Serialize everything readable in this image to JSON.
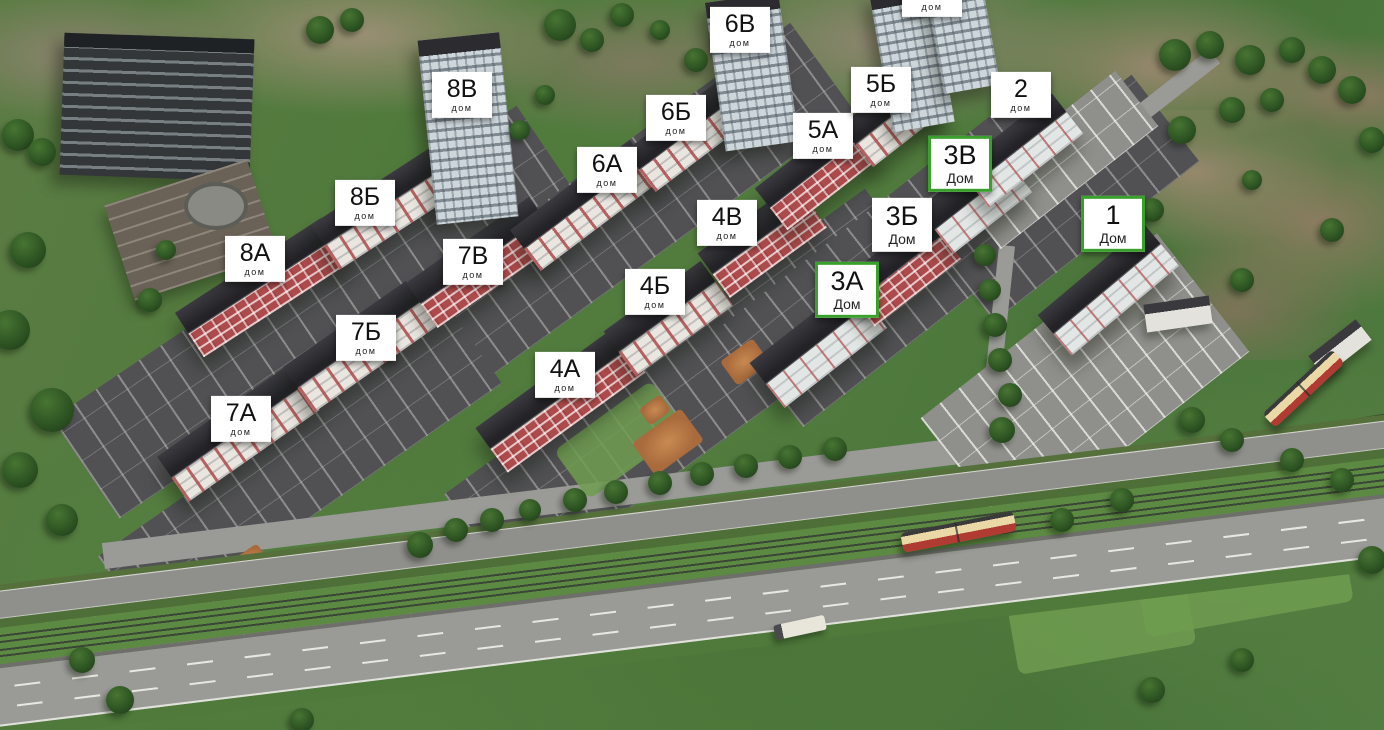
{
  "scene": {
    "description": "Aerial 3D master plan of a residential complex with numbered apartment buildings",
    "marker_colors": {
      "label_background": "#ffffff",
      "label_text": "#111111",
      "highlight_border": "#3aa02c"
    }
  },
  "buildings": [
    {
      "id": "8A",
      "label": "8А",
      "sublabel": "дом",
      "x": 255,
      "y": 259,
      "highlighted": false
    },
    {
      "id": "8B",
      "label": "8Б",
      "sublabel": "дом",
      "x": 365,
      "y": 203,
      "highlighted": false
    },
    {
      "id": "8V",
      "label": "8В",
      "sublabel": "дом",
      "x": 462,
      "y": 95,
      "highlighted": false
    },
    {
      "id": "7A",
      "label": "7А",
      "sublabel": "дом",
      "x": 241,
      "y": 419,
      "highlighted": false
    },
    {
      "id": "7B",
      "label": "7Б",
      "sublabel": "дом",
      "x": 366,
      "y": 338,
      "highlighted": false
    },
    {
      "id": "7V",
      "label": "7В",
      "sublabel": "дом",
      "x": 473,
      "y": 262,
      "highlighted": false
    },
    {
      "id": "6A",
      "label": "6А",
      "sublabel": "дом",
      "x": 607,
      "y": 170,
      "highlighted": false
    },
    {
      "id": "6B",
      "label": "6Б",
      "sublabel": "дом",
      "x": 676,
      "y": 118,
      "highlighted": false
    },
    {
      "id": "6V",
      "label": "6В",
      "sublabel": "дом",
      "x": 740,
      "y": 30,
      "highlighted": false
    },
    {
      "id": "5A",
      "label": "5А",
      "sublabel": "дом",
      "x": 823,
      "y": 136,
      "highlighted": false
    },
    {
      "id": "5B",
      "label": "5Б",
      "sublabel": "дом",
      "x": 881,
      "y": 90,
      "highlighted": false
    },
    {
      "id": "5V",
      "label": "5В",
      "sublabel": "дом",
      "x": 932,
      "y": -6,
      "highlighted": false
    },
    {
      "id": "4A",
      "label": "4А",
      "sublabel": "дом",
      "x": 565,
      "y": 375,
      "highlighted": false
    },
    {
      "id": "4B",
      "label": "4Б",
      "sublabel": "дом",
      "x": 655,
      "y": 292,
      "highlighted": false
    },
    {
      "id": "4V",
      "label": "4В",
      "sublabel": "дом",
      "x": 727,
      "y": 223,
      "highlighted": false
    },
    {
      "id": "3A",
      "label": "3А",
      "sublabel": "Дом",
      "x": 847,
      "y": 290,
      "highlighted": true
    },
    {
      "id": "3B",
      "label": "3Б",
      "sublabel": "Дом",
      "x": 902,
      "y": 225,
      "highlighted": false
    },
    {
      "id": "3V",
      "label": "3В",
      "sublabel": "Дом",
      "x": 960,
      "y": 164,
      "highlighted": true
    },
    {
      "id": "2",
      "label": "2",
      "sublabel": "дом",
      "x": 1021,
      "y": 95,
      "highlighted": false
    },
    {
      "id": "1",
      "label": "1",
      "sublabel": "Дом",
      "x": 1113,
      "y": 224,
      "highlighted": true
    }
  ]
}
